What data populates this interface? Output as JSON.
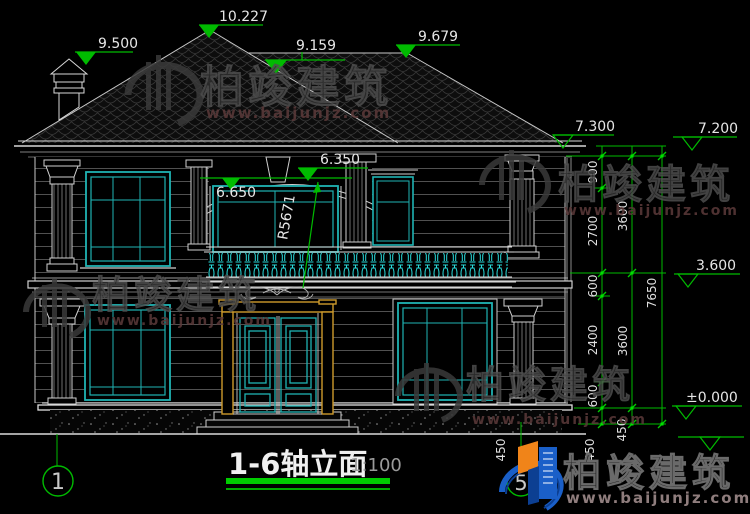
{
  "title": {
    "name": "1-6轴立面",
    "scale": "1:100"
  },
  "axes": {
    "left": "1",
    "right": "5"
  },
  "levels": {
    "chimney": "9.500",
    "peak": "10.227",
    "valley": "9.159",
    "ridge": "9.679",
    "eave_left": "7.300",
    "eave_right": "7.200",
    "arch_lower": "6.650",
    "arch_upper": "6.350",
    "second_floor": "3.600",
    "zero": "±0.000"
  },
  "dims": {
    "radius": "R5671",
    "right_inner": [
      "900",
      "2700",
      "600",
      "2400",
      "600",
      "450"
    ],
    "right_mid": [
      "3600",
      "3600",
      "450"
    ],
    "right_total": "7650",
    "step": "450"
  },
  "watermark": {
    "brand": "柏竣建筑",
    "url": "www.baijunjz.com"
  },
  "colors": {
    "line": "#d8d8d8",
    "teal": "#1fb3b3",
    "baluster": "#2adddd",
    "dim_green": "#00bb00",
    "door_gold": "#cd9a2b",
    "logo_blue": "#1a5fc8",
    "logo_orange": "#f08419"
  }
}
